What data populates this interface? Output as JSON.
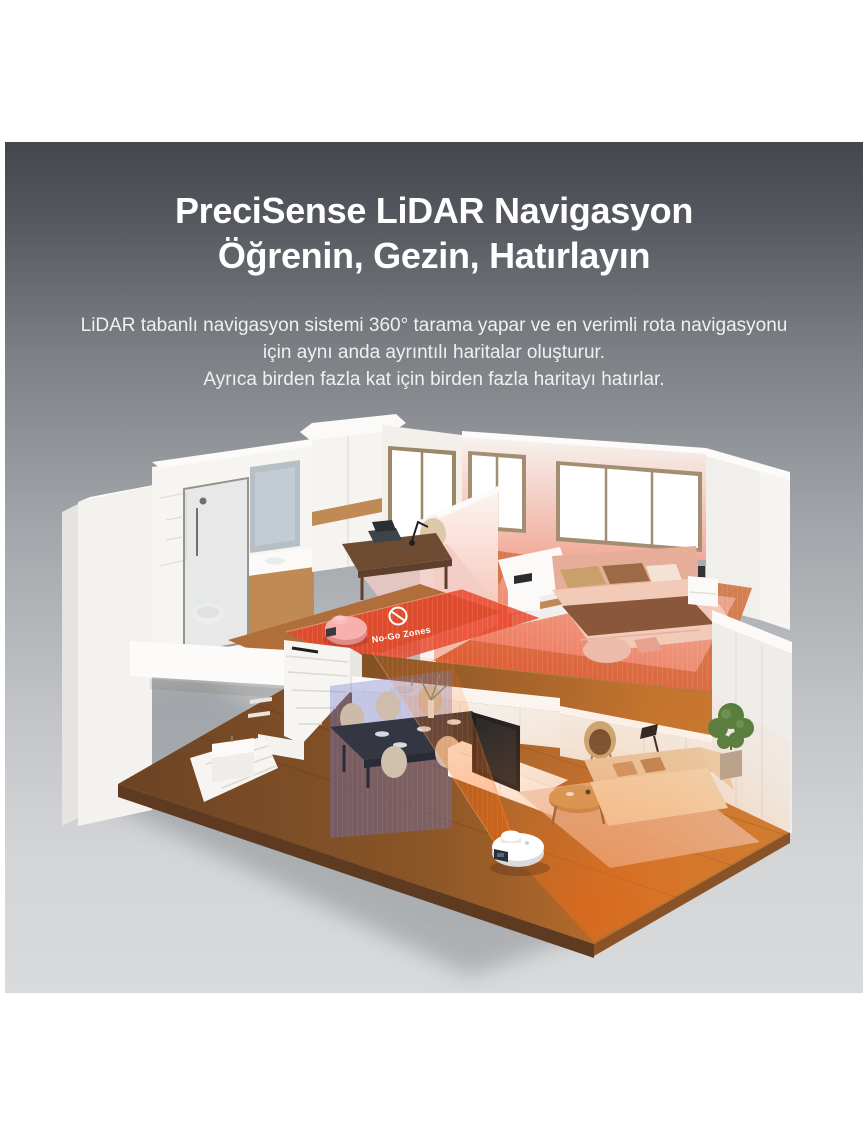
{
  "hero": {
    "title_line1": "PreciSense LiDAR Navigasyon",
    "title_line2": "Öğrenin, Gezin, Hatırlayın",
    "subtitle_lines": [
      "LiDAR tabanlı navigasyon sistemi 360° tarama yapar ve en verimli rota navigasyonu",
      "için aynı anda ayrıntılı haritalar oluşturur.",
      "Ayrıca birden fazla kat için birden fazla haritayı hatırlar."
    ],
    "text_color": "#ffffff"
  },
  "scene": {
    "no_go_zone_label": "No-Go Zones",
    "prohibition_icon": "no-entry-circle-slash",
    "colors": {
      "no_go_zone_red": "#e8462c",
      "scan_orange": "#ff7a1e",
      "scan_blue": "rgba(104,118,210,0.28)",
      "robot_pink": "#f6b0ae",
      "robot_white": "#ffffff",
      "wood_floor_light": "#c4772e",
      "wood_floor_dark": "#6b4526",
      "wall_white": "#f6f4f1"
    }
  }
}
